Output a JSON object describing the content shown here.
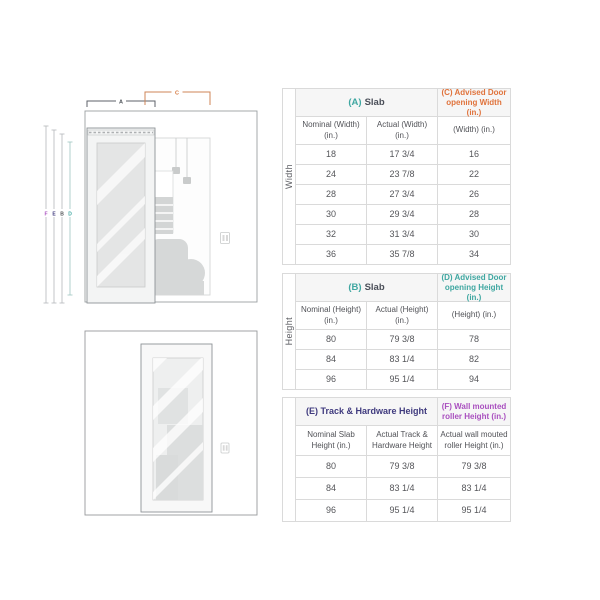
{
  "diagram": {
    "bracket_labels": {
      "a": "A",
      "c": "C"
    },
    "height_line_labels": {
      "f": "F",
      "e": "E",
      "b": "B",
      "d": "D"
    },
    "colors": {
      "teal": "#3FA7A1",
      "orange": "#E0733C",
      "indigo": "#3F3A7E",
      "magenta": "#A94FBF",
      "bracket_a": "#5D6268",
      "bracket_c": "#CF8457",
      "wall_outline": "#9B9FA2",
      "furniture_gray": "#D6D8D8"
    }
  },
  "tables": {
    "width": {
      "side_label": "Width",
      "slab_header_prefix": "(A)",
      "slab_header_title": "Slab",
      "advised_header": "(C) Advised Door opening Width (in.)",
      "col_headers": [
        "Nominal (Width) (in.)",
        "Actual (Width) (in.)",
        "(Width) (in.)"
      ],
      "rows": [
        [
          "18",
          "17 3/4",
          "16"
        ],
        [
          "24",
          "23 7/8",
          "22"
        ],
        [
          "28",
          "27 3/4",
          "26"
        ],
        [
          "30",
          "29 3/4",
          "28"
        ],
        [
          "32",
          "31 3/4",
          "30"
        ],
        [
          "36",
          "35 7/8",
          "34"
        ]
      ]
    },
    "height": {
      "side_label": "Height",
      "slab_header_prefix": "(B)",
      "slab_header_title": "Slab",
      "advised_header": "(D) Advised Door opening Height (in.)",
      "col_headers": [
        "Nominal (Height) (in.)",
        "Actual (Height) (in.)",
        "(Height) (in.)"
      ],
      "rows": [
        [
          "80",
          "79 3/8",
          "78"
        ],
        [
          "84",
          "83 1/4",
          "82"
        ],
        [
          "96",
          "95 1/4",
          "94"
        ]
      ]
    },
    "track": {
      "left_header": "(E) Track & Hardware Height",
      "right_header": "(F) Wall mounted roller Height (in.)",
      "col_headers": [
        "Nominal Slab Height (in.)",
        "Actual Track & Hardware Height",
        "Actual wall mouted roller Height (in.)"
      ],
      "rows": [
        [
          "80",
          "79 3/8",
          "79 3/8"
        ],
        [
          "84",
          "83 1/4",
          "83 1/4"
        ],
        [
          "96",
          "95 1/4",
          "95 1/4"
        ]
      ]
    }
  }
}
